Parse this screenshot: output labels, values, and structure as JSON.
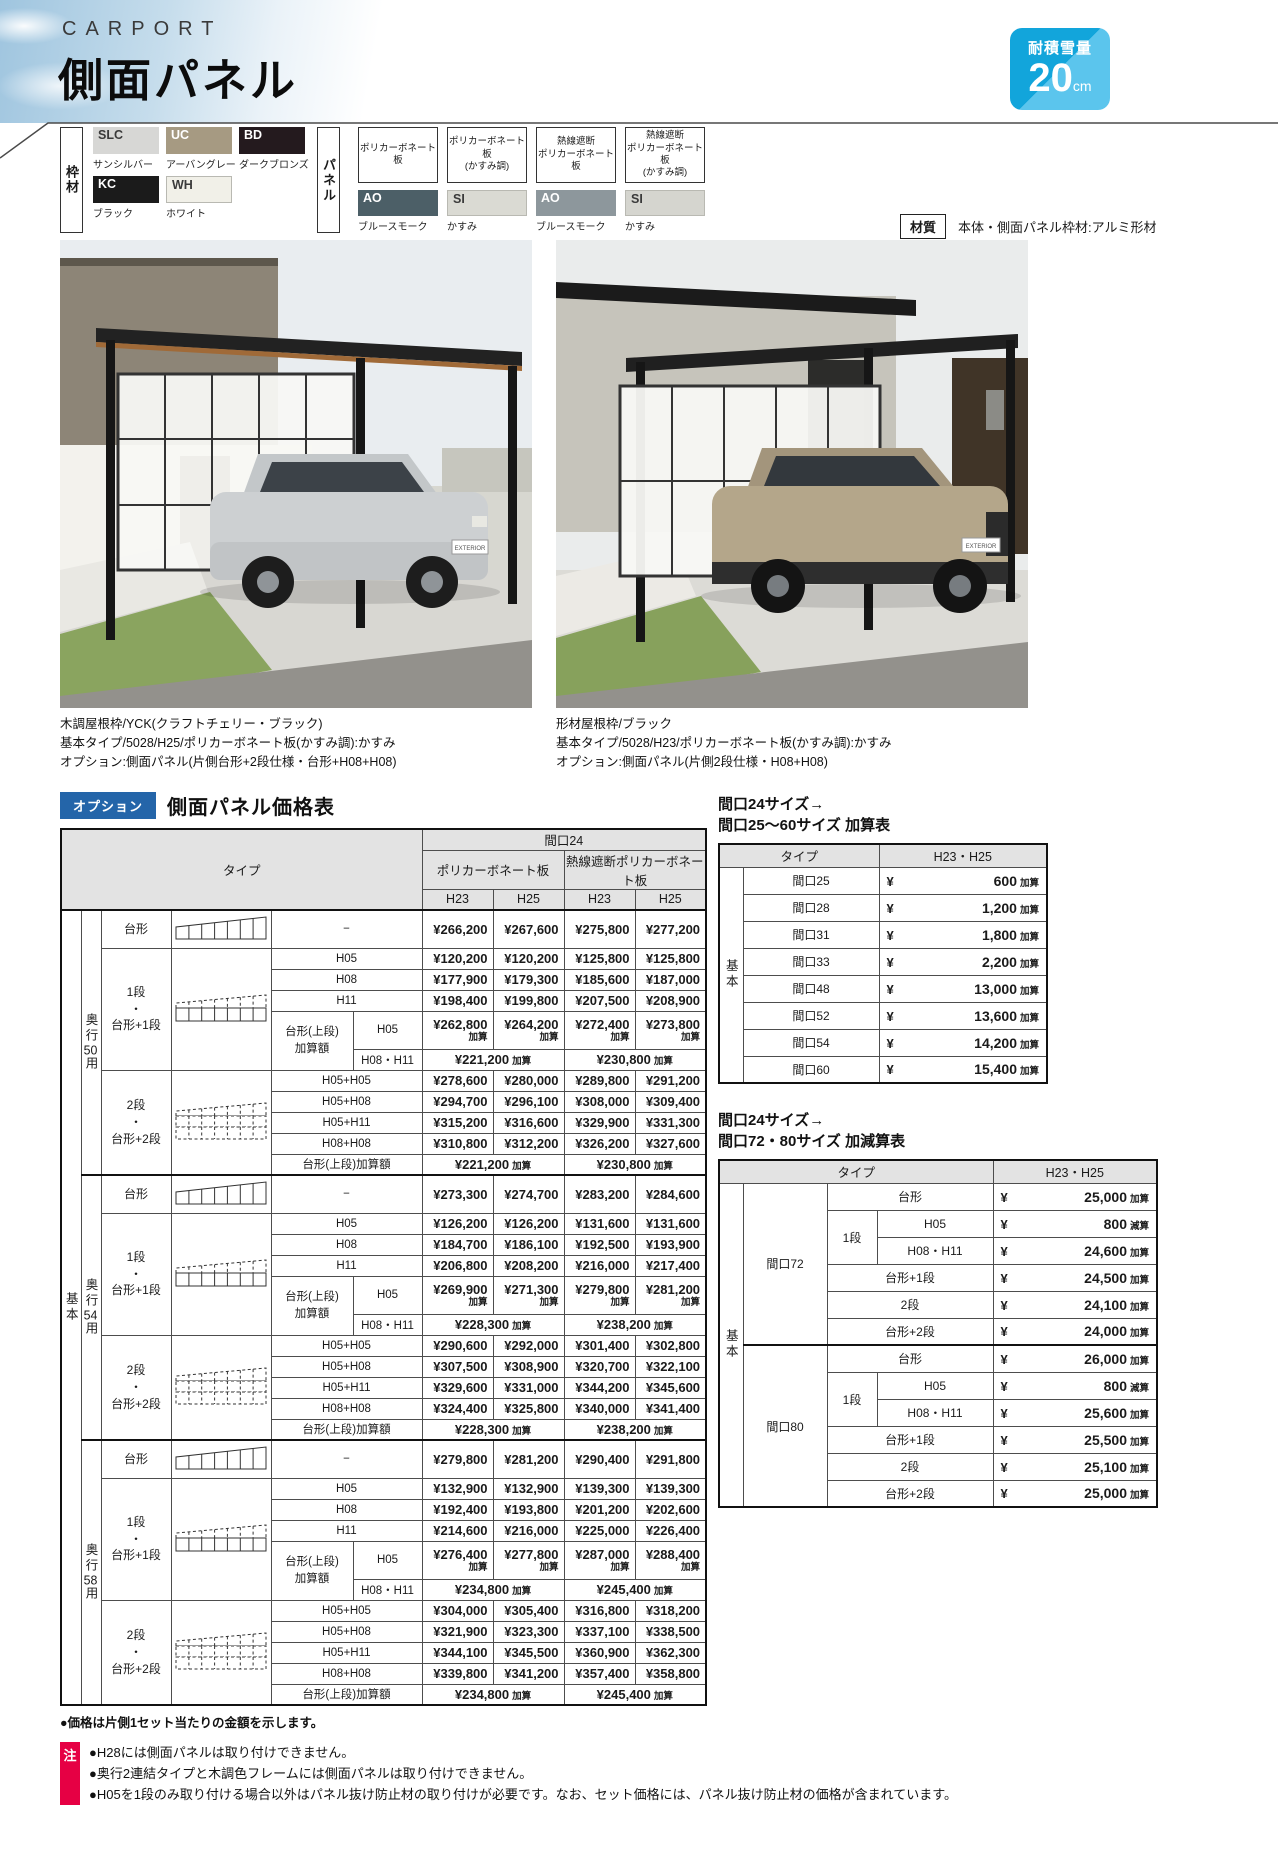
{
  "header": {
    "category": "CARPORT",
    "title": "側面パネル",
    "snow_badge": {
      "label": "耐積雪量",
      "value": "20",
      "unit": "cm"
    }
  },
  "materials": {
    "frame_label": "枠材",
    "frame": {
      "swatches": [
        {
          "code": "SLC",
          "name": "サンシルバー",
          "color": "#d7d7d5",
          "text": "#3a3a3a"
        },
        {
          "code": "UC",
          "name": "アーバングレー",
          "color": "#a69a82",
          "text": "#ffffff"
        },
        {
          "code": "BD",
          "name": "ダークブロンズ",
          "color": "#241a1e",
          "text": "#ffffff"
        },
        {
          "code": "KC",
          "name": "ブラック",
          "color": "#1b1b1b",
          "text": "#ffffff"
        },
        {
          "code": "WH",
          "name": "ホワイト",
          "color": "#f1f0e8",
          "text": "#3a3a3a",
          "border": true
        }
      ]
    },
    "panel_label": "パネル",
    "panel": {
      "types": [
        {
          "type": "ポリカーボネート板",
          "code": "AO",
          "name": "ブルースモーク",
          "color": "#4c5f67",
          "text": "#ffffff"
        },
        {
          "type": "ポリカーボネート板\n(かすみ調)",
          "code": "SI",
          "name": "かすみ",
          "color": "#dadad3",
          "text": "#3a3a3a",
          "border": true
        },
        {
          "type": "熱線遮断\nポリカーボネート板",
          "code": "AO",
          "name": "ブルースモーク",
          "color": "#8d979c",
          "text": "#ffffff"
        },
        {
          "type": "熱線遮断\nポリカーボネート板\n(かすみ調)",
          "code": "SI",
          "name": "かすみ",
          "color": "#d5d5cf",
          "text": "#3a3a3a",
          "border": true
        }
      ]
    },
    "quality": {
      "label": "材質",
      "value": "本体・側面パネル枠材:アルミ形材"
    }
  },
  "photos": [
    {
      "plate": "EXTERIOR",
      "caption": [
        "木調屋根枠/YCK(クラフトチェリー・ブラック)",
        "基本タイプ/5028/H25/ポリカーボネート板(かすみ調):かすみ",
        "オプション:側面パネル(片側台形+2段仕様・台形+H08+H08)"
      ]
    },
    {
      "plate": "EXTERIOR",
      "caption": [
        "形材屋根枠/ブラック",
        "基本タイプ/5028/H23/ポリカーボネート板(かすみ調):かすみ",
        "オプション:側面パネル(片側2段仕様・H08+H08)"
      ]
    }
  ],
  "price_table": {
    "badge": "オプション",
    "title": "側面パネル価格表",
    "type_header": "タイプ",
    "col_group": "間口24",
    "panel_groups": [
      "ポリカーボネート板",
      "熱線遮断ポリカーボネート板"
    ],
    "heights": [
      "H23",
      "H25",
      "H23",
      "H25"
    ],
    "base_label": "基本",
    "add_suffix": "加算",
    "taikei_sub": "−",
    "blocks": [
      {
        "depth": "奥行50用",
        "taikei_label": "台形",
        "taikei_prices": [
          "¥266,200",
          "¥267,600",
          "¥275,800",
          "¥277,200"
        ],
        "dan1_label": "1段\n・\n台形+1段",
        "dan1_rows": [
          {
            "sub": "H05",
            "prices": [
              "¥120,200",
              "¥120,200",
              "¥125,800",
              "¥125,800"
            ]
          },
          {
            "sub": "H08",
            "prices": [
              "¥177,900",
              "¥179,300",
              "¥185,600",
              "¥187,000"
            ]
          },
          {
            "sub": "H11",
            "prices": [
              "¥198,400",
              "¥199,800",
              "¥207,500",
              "¥208,900"
            ]
          }
        ],
        "dan1_add_label": "台形(上段)\n加算額",
        "dan1_add_h05": {
          "sub": "H05",
          "prices": [
            "¥262,800",
            "¥264,200",
            "¥272,400",
            "¥273,800"
          ]
        },
        "dan1_add_h0811": {
          "sub": "H08・H11",
          "poly": "¥221,200",
          "heat": "¥230,800"
        },
        "dan2_label": "2段\n・\n台形+2段",
        "dan2_rows": [
          {
            "sub": "H05+H05",
            "prices": [
              "¥278,600",
              "¥280,000",
              "¥289,800",
              "¥291,200"
            ]
          },
          {
            "sub": "H05+H08",
            "prices": [
              "¥294,700",
              "¥296,100",
              "¥308,000",
              "¥309,400"
            ]
          },
          {
            "sub": "H05+H11",
            "prices": [
              "¥315,200",
              "¥316,600",
              "¥329,900",
              "¥331,300"
            ]
          },
          {
            "sub": "H08+H08",
            "prices": [
              "¥310,800",
              "¥312,200",
              "¥326,200",
              "¥327,600"
            ]
          }
        ],
        "dan2_add_label": "台形(上段)加算額",
        "dan2_add": {
          "poly": "¥221,200",
          "heat": "¥230,800"
        }
      },
      {
        "depth": "奥行54用",
        "taikei_label": "台形",
        "taikei_prices": [
          "¥273,300",
          "¥274,700",
          "¥283,200",
          "¥284,600"
        ],
        "dan1_label": "1段\n・\n台形+1段",
        "dan1_rows": [
          {
            "sub": "H05",
            "prices": [
              "¥126,200",
              "¥126,200",
              "¥131,600",
              "¥131,600"
            ]
          },
          {
            "sub": "H08",
            "prices": [
              "¥184,700",
              "¥186,100",
              "¥192,500",
              "¥193,900"
            ]
          },
          {
            "sub": "H11",
            "prices": [
              "¥206,800",
              "¥208,200",
              "¥216,000",
              "¥217,400"
            ]
          }
        ],
        "dan1_add_label": "台形(上段)\n加算額",
        "dan1_add_h05": {
          "sub": "H05",
          "prices": [
            "¥269,900",
            "¥271,300",
            "¥279,800",
            "¥281,200"
          ]
        },
        "dan1_add_h0811": {
          "sub": "H08・H11",
          "poly": "¥228,300",
          "heat": "¥238,200"
        },
        "dan2_label": "2段\n・\n台形+2段",
        "dan2_rows": [
          {
            "sub": "H05+H05",
            "prices": [
              "¥290,600",
              "¥292,000",
              "¥301,400",
              "¥302,800"
            ]
          },
          {
            "sub": "H05+H08",
            "prices": [
              "¥307,500",
              "¥308,900",
              "¥320,700",
              "¥322,100"
            ]
          },
          {
            "sub": "H05+H11",
            "prices": [
              "¥329,600",
              "¥331,000",
              "¥344,200",
              "¥345,600"
            ]
          },
          {
            "sub": "H08+H08",
            "prices": [
              "¥324,400",
              "¥325,800",
              "¥340,000",
              "¥341,400"
            ]
          }
        ],
        "dan2_add_label": "台形(上段)加算額",
        "dan2_add": {
          "poly": "¥228,300",
          "heat": "¥238,200"
        }
      },
      {
        "depth": "奥行58用",
        "taikei_label": "台形",
        "taikei_prices": [
          "¥279,800",
          "¥281,200",
          "¥290,400",
          "¥291,800"
        ],
        "dan1_label": "1段\n・\n台形+1段",
        "dan1_rows": [
          {
            "sub": "H05",
            "prices": [
              "¥132,900",
              "¥132,900",
              "¥139,300",
              "¥139,300"
            ]
          },
          {
            "sub": "H08",
            "prices": [
              "¥192,400",
              "¥193,800",
              "¥201,200",
              "¥202,600"
            ]
          },
          {
            "sub": "H11",
            "prices": [
              "¥214,600",
              "¥216,000",
              "¥225,000",
              "¥226,400"
            ]
          }
        ],
        "dan1_add_label": "台形(上段)\n加算額",
        "dan1_add_h05": {
          "sub": "H05",
          "prices": [
            "¥276,400",
            "¥277,800",
            "¥287,000",
            "¥288,400"
          ]
        },
        "dan1_add_h0811": {
          "sub": "H08・H11",
          "poly": "¥234,800",
          "heat": "¥245,400"
        },
        "dan2_label": "2段\n・\n台形+2段",
        "dan2_rows": [
          {
            "sub": "H05+H05",
            "prices": [
              "¥304,000",
              "¥305,400",
              "¥316,800",
              "¥318,200"
            ]
          },
          {
            "sub": "H05+H08",
            "prices": [
              "¥321,900",
              "¥323,300",
              "¥337,100",
              "¥338,500"
            ]
          },
          {
            "sub": "H05+H11",
            "prices": [
              "¥344,100",
              "¥345,500",
              "¥360,900",
              "¥362,300"
            ]
          },
          {
            "sub": "H08+H08",
            "prices": [
              "¥339,800",
              "¥341,200",
              "¥357,400",
              "¥358,800"
            ]
          }
        ],
        "dan2_add_label": "台形(上段)加算額",
        "dan2_add": {
          "poly": "¥234,800",
          "heat": "¥245,400"
        }
      }
    ]
  },
  "side_table_a": {
    "title_lines": [
      "間口24サイズ→",
      "間口25〜60サイズ 加算表"
    ],
    "type_header": "タイプ",
    "height_header": "H23・H25",
    "base_label": "基本",
    "yen": "¥",
    "rows": [
      {
        "label": "間口25",
        "value": "600",
        "suffix": "加算"
      },
      {
        "label": "間口28",
        "value": "1,200",
        "suffix": "加算"
      },
      {
        "label": "間口31",
        "value": "1,800",
        "suffix": "加算"
      },
      {
        "label": "間口33",
        "value": "2,200",
        "suffix": "加算"
      },
      {
        "label": "間口48",
        "value": "13,000",
        "suffix": "加算"
      },
      {
        "label": "間口52",
        "value": "13,600",
        "suffix": "加算"
      },
      {
        "label": "間口54",
        "value": "14,200",
        "suffix": "加算"
      },
      {
        "label": "間口60",
        "value": "15,400",
        "suffix": "加算"
      }
    ]
  },
  "side_table_b": {
    "title_lines": [
      "間口24サイズ→",
      "間口72・80サイズ 加減算表"
    ],
    "type_header": "タイプ",
    "height_header": "H23・H25",
    "base_label": "基本",
    "yen": "¥",
    "groups": [
      {
        "span": "間口72",
        "rows": [
          {
            "wide": "台形",
            "value": "25,000",
            "suffix": "加算"
          },
          {
            "group": "1段",
            "sub": "H05",
            "value": "800",
            "suffix": "減算"
          },
          {
            "sub": "H08・H11",
            "value": "24,600",
            "suffix": "加算"
          },
          {
            "wide": "台形+1段",
            "value": "24,500",
            "suffix": "加算"
          },
          {
            "wide": "2段",
            "value": "24,100",
            "suffix": "加算"
          },
          {
            "wide": "台形+2段",
            "value": "24,000",
            "suffix": "加算"
          }
        ]
      },
      {
        "span": "間口80",
        "rows": [
          {
            "wide": "台形",
            "value": "26,000",
            "suffix": "加算"
          },
          {
            "group": "1段",
            "sub": "H05",
            "value": "800",
            "suffix": "減算"
          },
          {
            "sub": "H08・H11",
            "value": "25,600",
            "suffix": "加算"
          },
          {
            "wide": "台形+1段",
            "value": "25,500",
            "suffix": "加算"
          },
          {
            "wide": "2段",
            "value": "25,100",
            "suffix": "加算"
          },
          {
            "wide": "台形+2段",
            "value": "25,000",
            "suffix": "加算"
          }
        ]
      }
    ]
  },
  "footer": {
    "price_note": "●価格は片側1セット当たりの金額を示します。",
    "note_badge": "注",
    "notes": [
      "●H28には側面パネルは取り付けできません。",
      "●奥行2連結タイプと木調色フレームには側面パネルは取り付けできません。",
      "●H05を1段のみ取り付ける場合以外はパネル抜け防止材の取り付けが必要です。なお、セット価格には、パネル抜け防止材の価格が含まれています。"
    ]
  }
}
